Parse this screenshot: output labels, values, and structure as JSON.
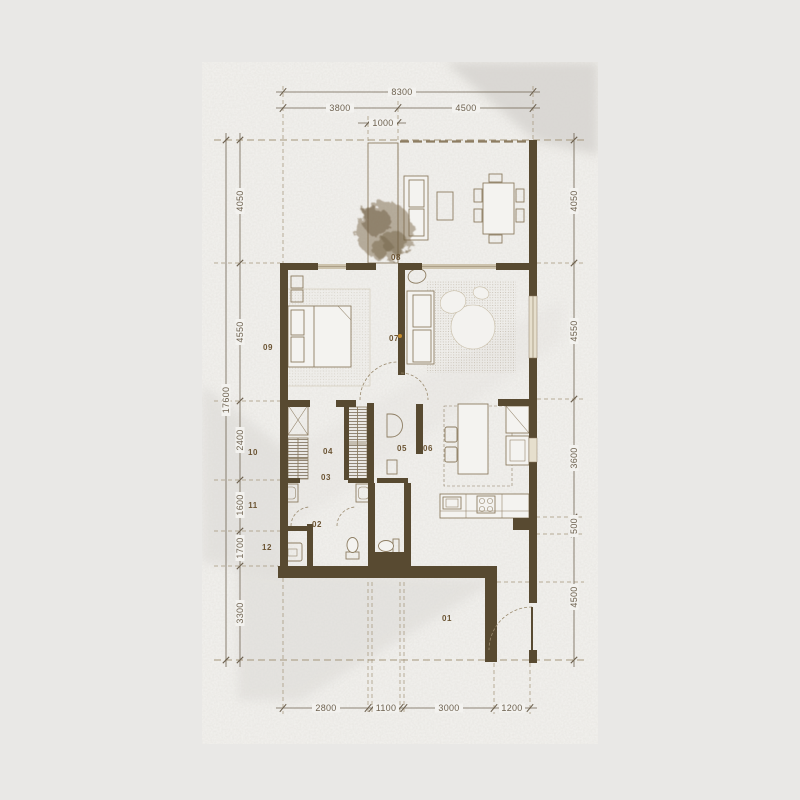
{
  "sheet": {
    "type": "apartment floor plan drawing"
  },
  "dimensions": {
    "top": [
      "8300",
      "3800",
      "4500",
      "1000"
    ],
    "left": [
      "17600",
      "4050",
      "4550",
      "2400",
      "1600",
      "1700",
      "3300"
    ],
    "right": [
      "4050",
      "4550",
      "3600",
      "500",
      "4500"
    ],
    "bottom": [
      "2800",
      "1100",
      "3000",
      "1200"
    ]
  },
  "rooms": [
    "01",
    "02",
    "03",
    "04",
    "05",
    "06",
    "07",
    "08",
    "09",
    "10",
    "11",
    "12"
  ],
  "colors": {
    "background": "#e9e8e6",
    "paper": "#f3f2ef",
    "shade": "#d8d6d2",
    "wall": "#584a31",
    "furniture_line": "#8d7d62",
    "dimension_line": "#6e6250",
    "extension_line": "#a5977c",
    "room_label": "#6b5433",
    "window_fill": "#cdc3ad",
    "door_marker": "#c58a2a"
  }
}
